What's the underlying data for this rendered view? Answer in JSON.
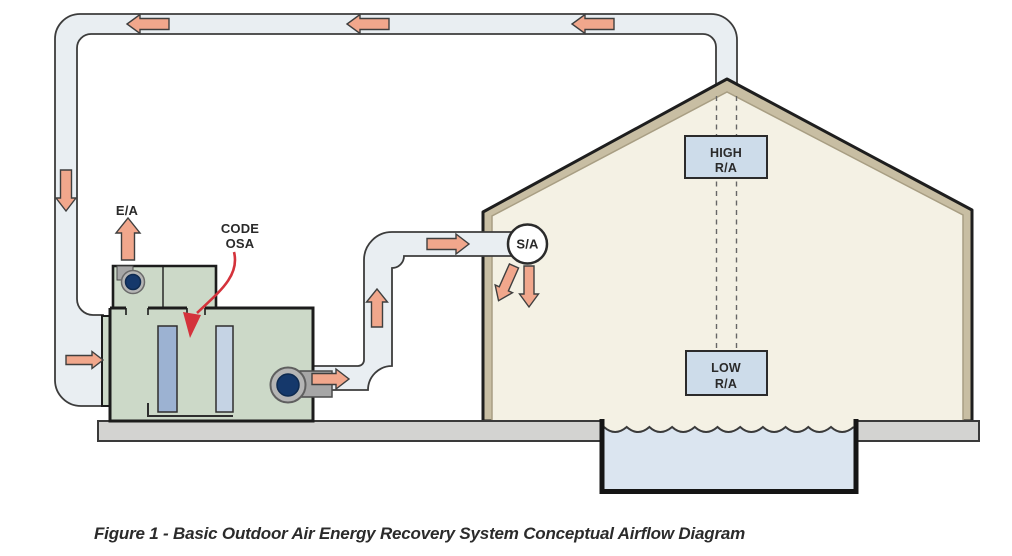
{
  "figure": {
    "caption": "Figure 1 - Basic Outdoor Air Energy Recovery System Conceptual Airflow Diagram"
  },
  "labels": {
    "exhaust_air": "E/A",
    "code_osa_line1": "CODE",
    "code_osa_line2": "OSA",
    "supply_air": "S/A",
    "high_return_line1": "HIGH",
    "high_return_line2": "R/A",
    "low_return_line1": "LOW",
    "low_return_line2": "R/A"
  },
  "colors": {
    "duct_fill": "#e9eef2",
    "duct_stroke": "#3c3c3c",
    "arrow_fill": "#f1a78c",
    "unit_fill": "#ccd9c8",
    "slat_dark": "#9cb2d2",
    "slat_light": "#c5d3e4",
    "fan_navy": "#15386b",
    "fan_gray": "#b5b5b5",
    "roof_tan": "#c8bea3",
    "interior_cream": "#f4f1e4",
    "ra_box_blue": "#cddcea",
    "platform_gray": "#d3d3d1",
    "water_blue": "#dbe5f0",
    "annotation_red": "#d4323b"
  }
}
